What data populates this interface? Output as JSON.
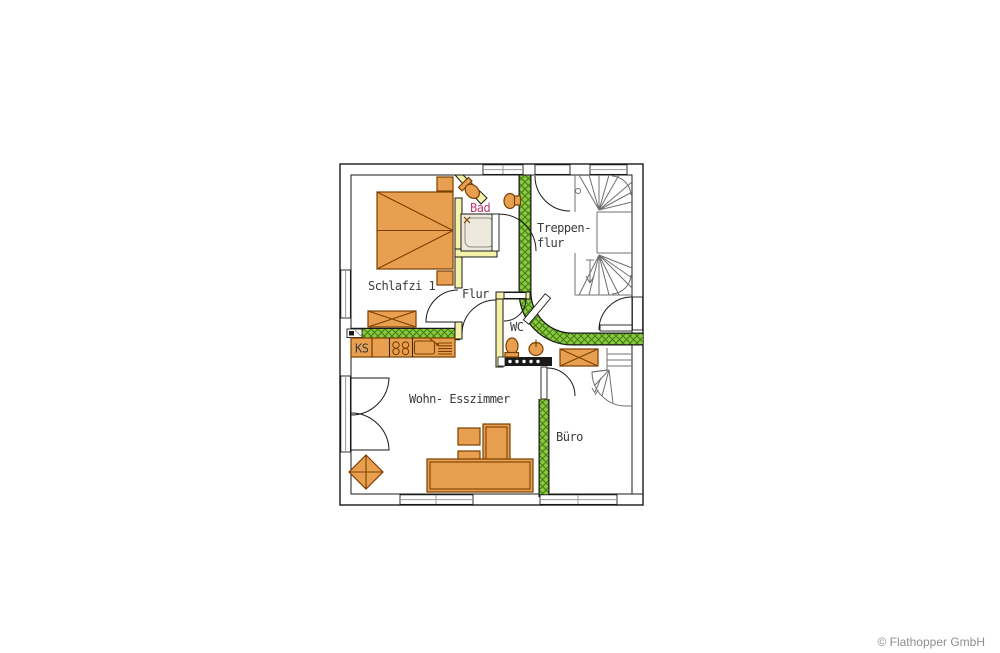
{
  "page": {
    "background": "#ffffff"
  },
  "footer": {
    "copyright": "© Flathopper GmbH"
  },
  "colors": {
    "floor": "#E8A050",
    "wall-yellow": "#F5F1A8",
    "wall-green": "#8CC83C",
    "wall-green-dark": "#3f7d1a",
    "hatch-line": "#4a4a42",
    "stairwell-floor": "#ffffff",
    "outline": "#1a1a1a",
    "furniture": "#7B3F00",
    "stair": "#707070",
    "label": "#3b3b3b",
    "bad-label": "#C13A6E",
    "copyright": "#8f8f8f"
  },
  "rooms": {
    "schlafzimmer": {
      "label": "Schlafzi 1"
    },
    "bad": {
      "label": "Bad"
    },
    "treppenflur": {
      "line1": "Treppen-",
      "line2": "flur"
    },
    "flur": {
      "label": "Flur"
    },
    "wc": {
      "label": "WC"
    },
    "kueche": {
      "label": "KS"
    },
    "wohnesszimmer": {
      "label": "Wohn- Esszimmer"
    },
    "buero": {
      "label": "Büro"
    }
  }
}
